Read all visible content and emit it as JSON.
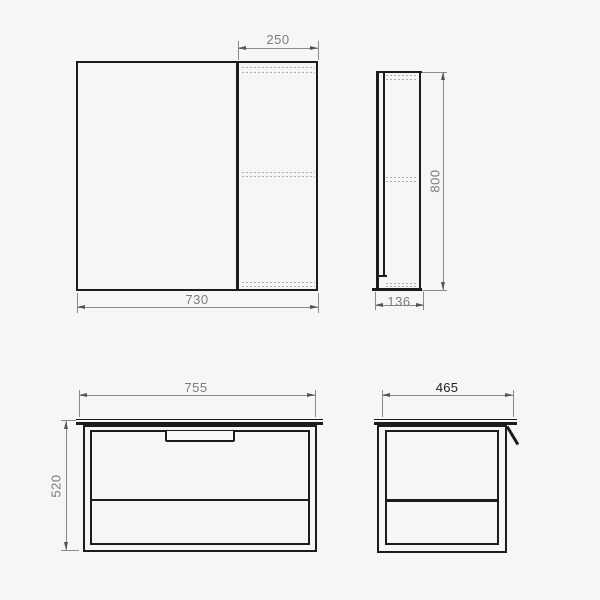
{
  "drawing": {
    "background_color": "#f6f6f4",
    "line_color": "#1c1c1c",
    "dimension_color": "#8a8a8a",
    "dimensions": {
      "mirror_front": {
        "door_width": "250",
        "total_width": "730"
      },
      "mirror_side": {
        "height": "800",
        "depth": "136"
      },
      "vanity_front": {
        "width": "755",
        "height": "520"
      },
      "vanity_side": {
        "depth": "465"
      }
    }
  }
}
